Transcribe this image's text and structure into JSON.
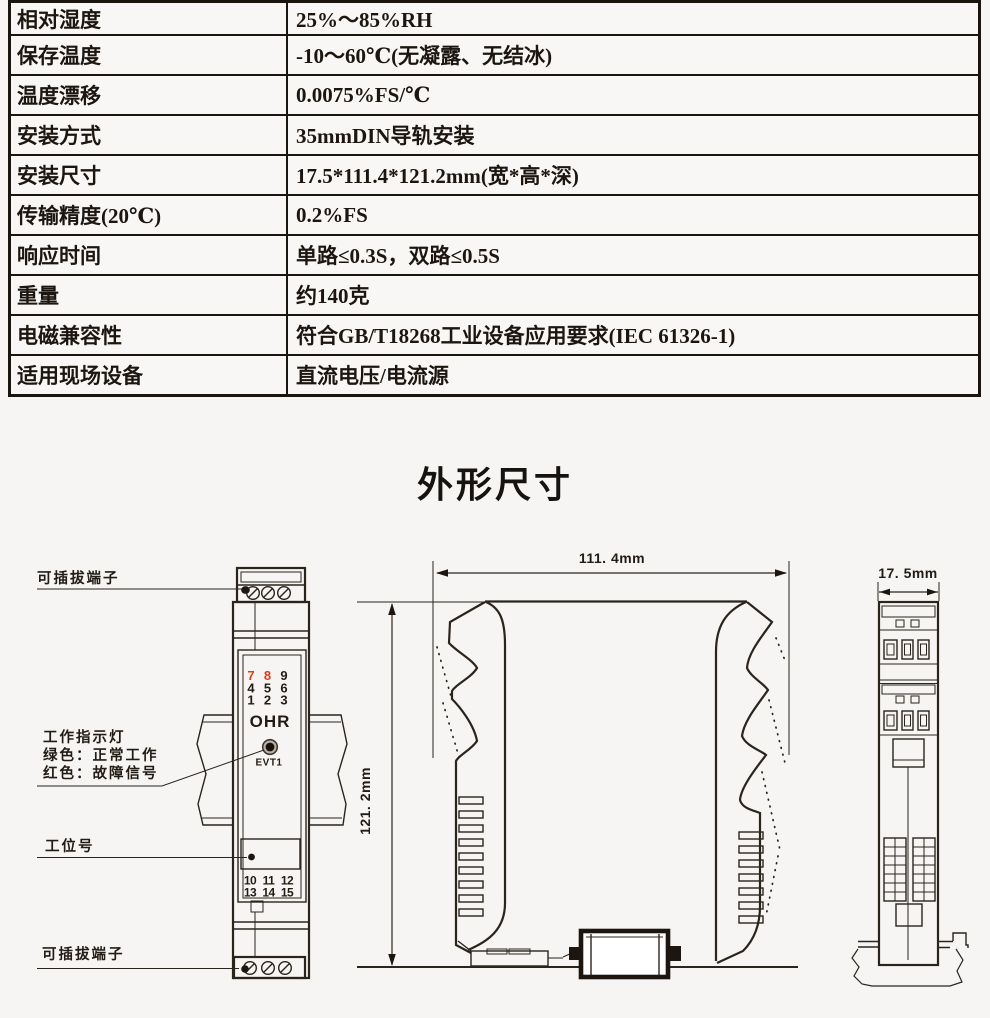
{
  "spec_table": {
    "rows": [
      {
        "label": "相对湿度",
        "value": "25%～85%RH"
      },
      {
        "label": "保存温度",
        "value": "-10～60℃(无凝露、无结冰)"
      },
      {
        "label": "温度漂移",
        "value": "0.0075%FS/℃"
      },
      {
        "label": "安装方式",
        "value": "35mmDIN导轨安装"
      },
      {
        "label": "安装尺寸",
        "value": "17.5*111.4*121.2mm(宽*高*深)"
      },
      {
        "label": "传输精度(20℃)",
        "value": "0.2%FS"
      },
      {
        "label": "响应时间",
        "value": "单路≤0.3S，双路≤0.5S"
      },
      {
        "label": "重量",
        "value": "约140克"
      },
      {
        "label": "电磁兼容性",
        "value": "符合GB/T18268工业设备应用要求(IEC 61326-1)"
      },
      {
        "label": "适用现场设备",
        "value": "直流电压/电流源"
      }
    ]
  },
  "section_title": "外形尺寸",
  "drawings": {
    "front_view": {
      "label_top_terminal": "可插拔端子",
      "label_indicator_line1": "工作指示灯",
      "label_indicator_line2": "绿色：正常工作",
      "label_indicator_line3": "红色：故障信号",
      "label_station": "工位号",
      "label_bottom_terminal": "可插拔端子",
      "terminals_top": [
        "7",
        "8",
        "9",
        "4",
        "5",
        "6",
        "1",
        "2",
        "3"
      ],
      "brand": "OHR",
      "led_tag": "EVT1",
      "terminals_bottom": [
        "10",
        "11",
        "12",
        "13",
        "14",
        "15"
      ]
    },
    "side_view": {
      "width_dim": "111. 4mm",
      "height_dim": "121. 2mm"
    },
    "end_view": {
      "depth_dim": "17. 5mm"
    },
    "colors": {
      "line": "#2b241d",
      "terminal_red": "#e23c16",
      "led_ring": "#b9b0a7",
      "led_core": "#17110c"
    }
  }
}
